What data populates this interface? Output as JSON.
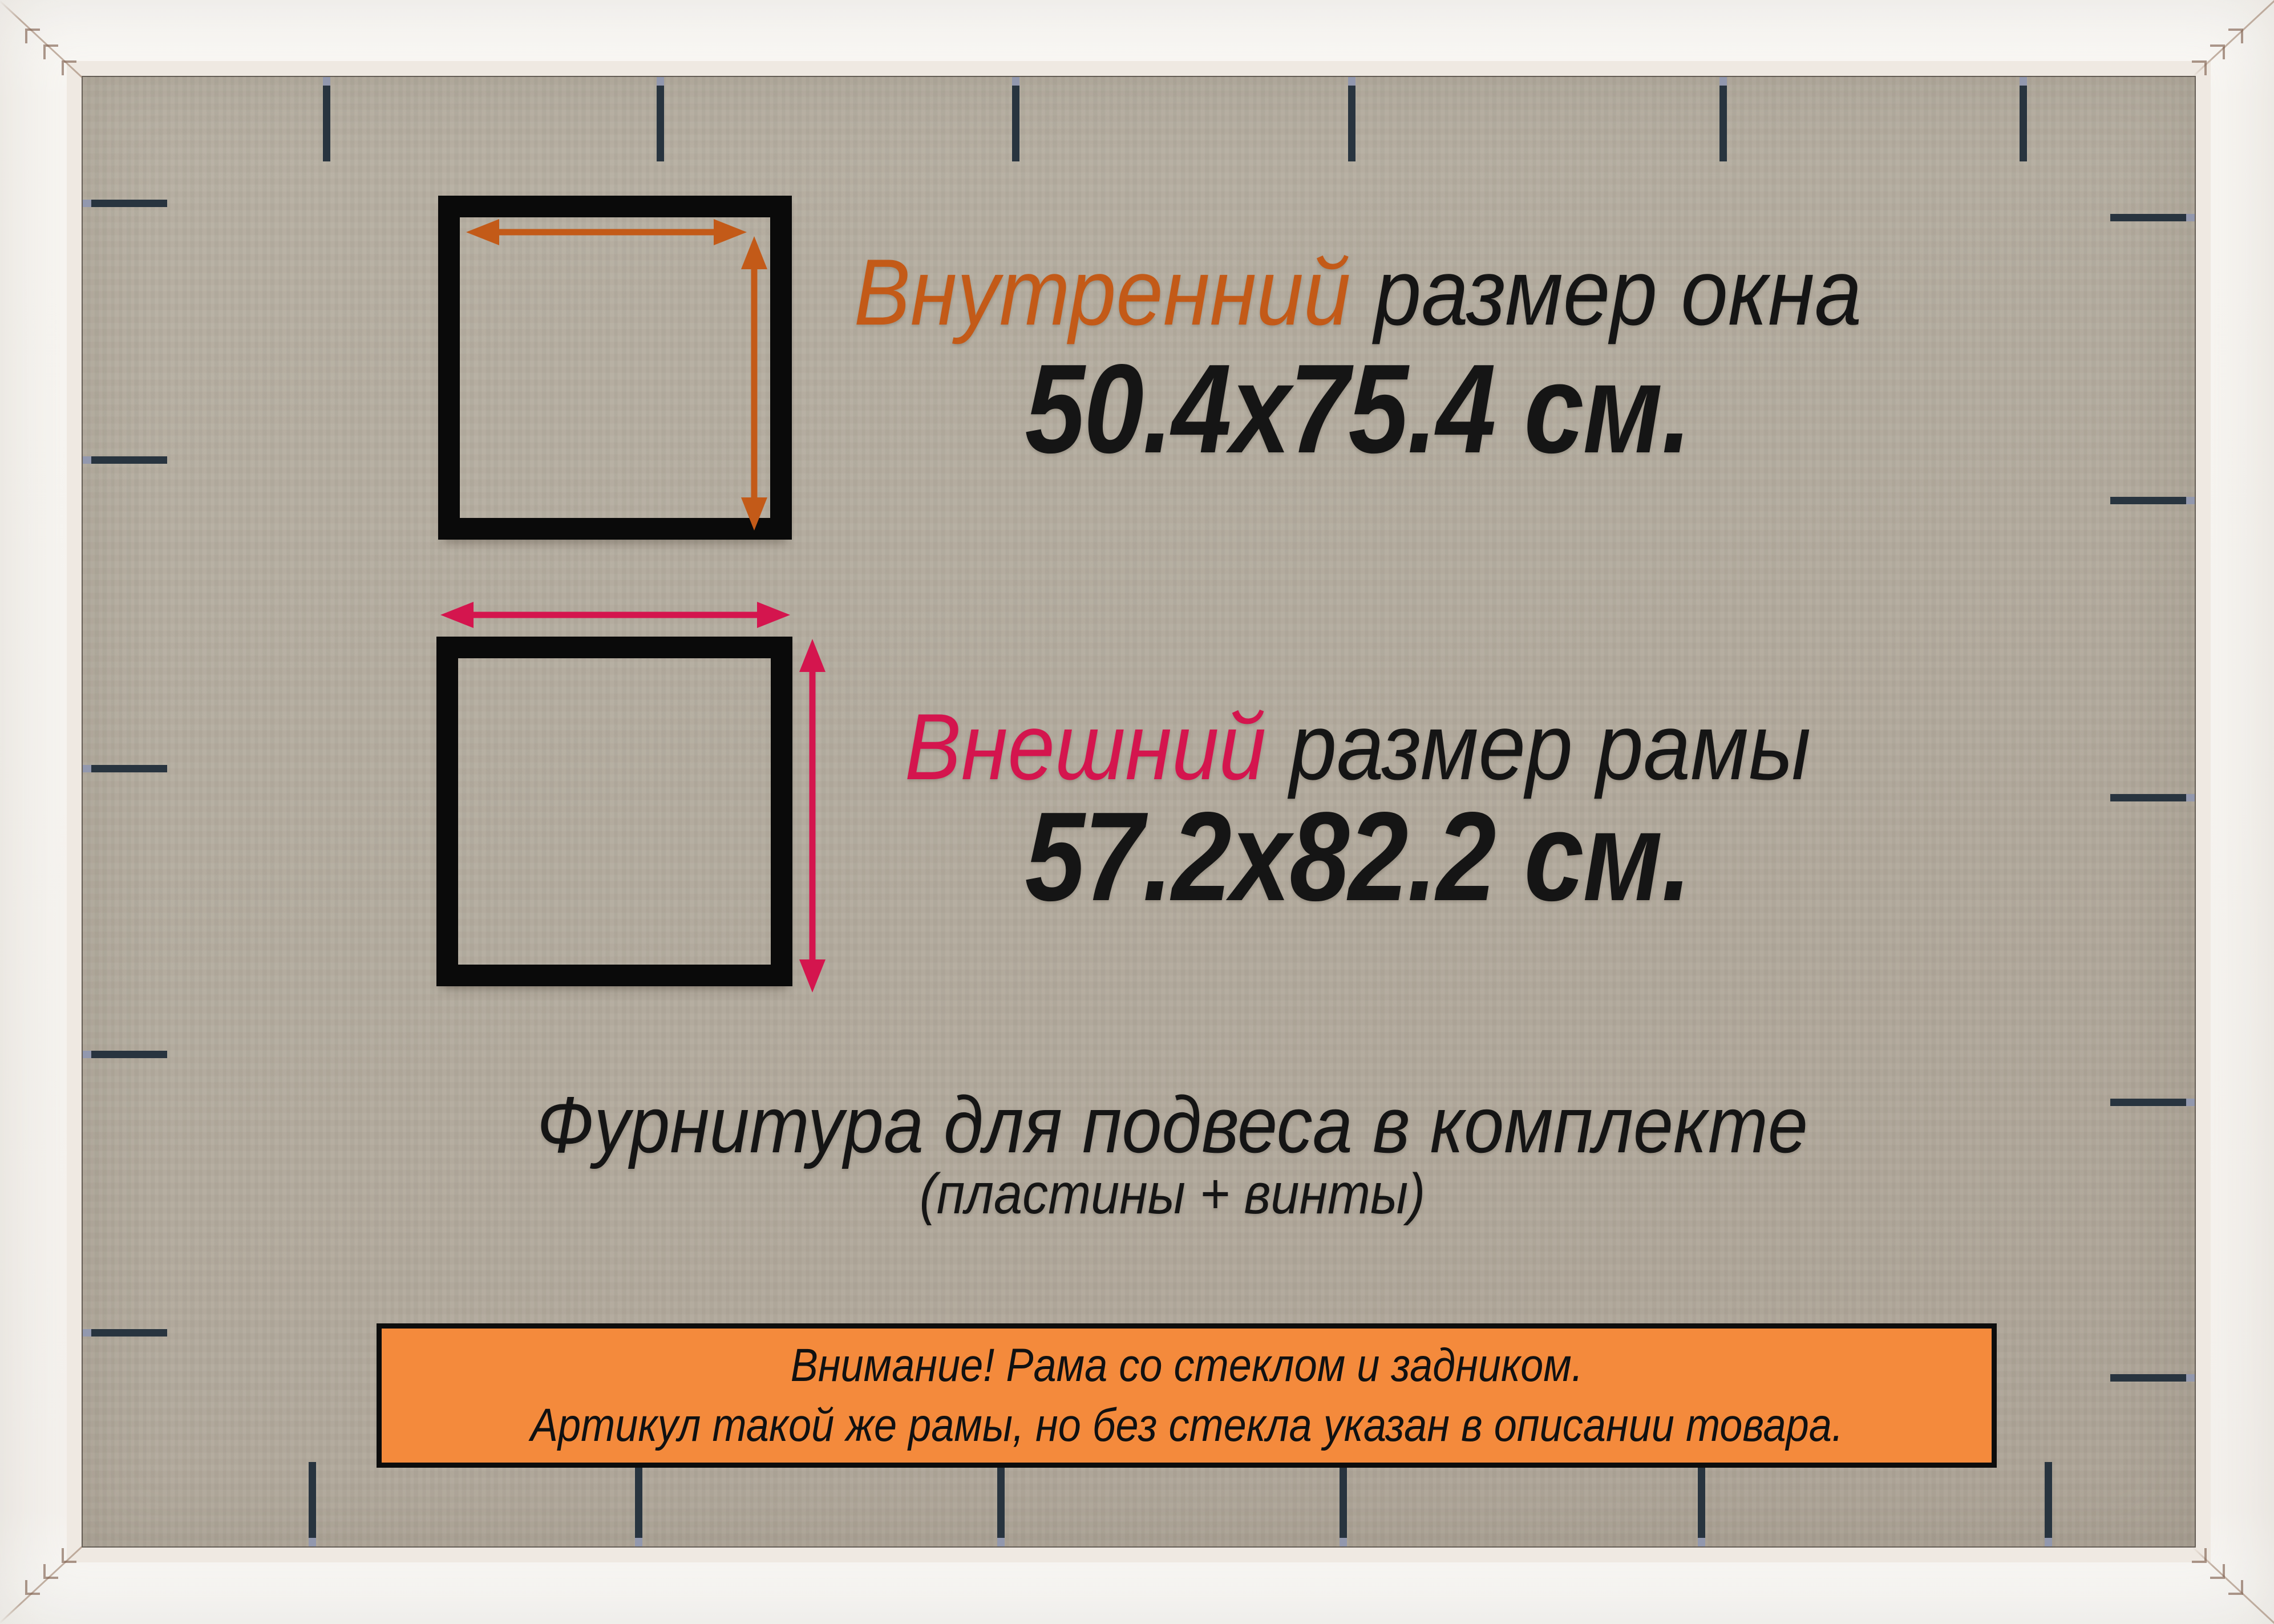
{
  "diagram": {
    "inner": {
      "highlight": "Внутренний",
      "rest": " размер окна",
      "size_label": "50.4x75.4 см.",
      "width_cm": 50.4,
      "height_cm": 75.4
    },
    "outer": {
      "highlight": "Внешний",
      "rest": " размер рамы",
      "size_label": "57.2x82.2 см.",
      "width_cm": 57.2,
      "height_cm": 82.2
    },
    "hardware": {
      "line1": "Фурнитура для подвеса в комплекте",
      "line2": "(пластины + винты)"
    },
    "notice": {
      "line1": "Внимание! Рама со стеклом и задником.",
      "line2": "Артикул такой же рамы, но без стекла указан в описании товара."
    },
    "icons": {
      "horizontal_measure": "double-arrow-horizontal",
      "vertical_measure": "double-arrow-vertical"
    },
    "colors": {
      "inner_accent": "#c35a18",
      "outer_accent": "#d4154e",
      "banner_background": "#f48a3c",
      "square_stroke": "#0a0a0a",
      "backing_board": "#b3ab9e",
      "frame": "#f6f4f0",
      "clip": "#28343f",
      "text": "#151515"
    }
  }
}
